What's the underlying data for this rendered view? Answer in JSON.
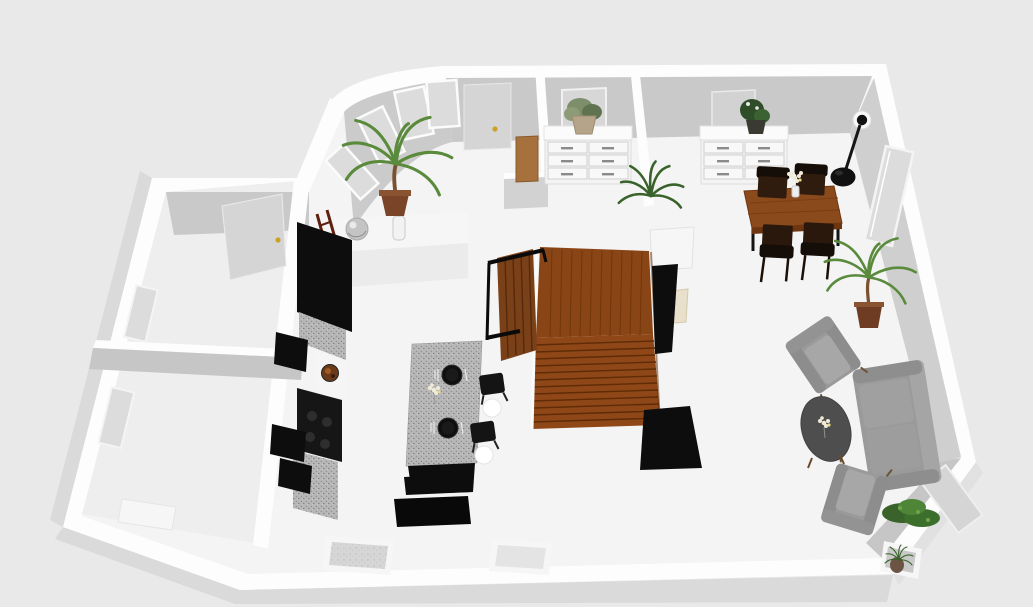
{
  "canvas": {
    "background": "#e9e9e9",
    "width": 1033,
    "height": 607
  },
  "scene": {
    "type": "3d-floor-plan-render",
    "camera": "elevated-perspective",
    "text_visible": false
  },
  "colors": {
    "wall_top": "#fdfdfd",
    "wall_face": "#c9c9c9",
    "wall_face_light": "#d2d2d2",
    "wall_outer_face": "#dadada",
    "floor": "#f4f4f4",
    "floor_annex": "#eeeeee",
    "window_glass": "#dcdcdc",
    "door_panel": "#d5d5d5",
    "handle_gold": "#c9a227",
    "stair_wood": "#8a4516",
    "stair_wood_dark": "#5e2c06",
    "railing_wood": "#7a4018",
    "table_wood": "#8b4a1c",
    "cabinet_black": "#0d0d0d",
    "granite_base": "#b7b7b7",
    "furniture_white": "#f6f6f6",
    "sofa_gray": "#9a9a9a",
    "coffee_table_gray": "#4e4e4e",
    "plant_green": "#5a8a3c",
    "plant_green_dark": "#39632a",
    "pot_brown": "#7a4428",
    "lamp_black": "#111111",
    "ladder_red": "#5e1f10",
    "pendant_white": "#ffffff"
  },
  "inventory": {
    "rooms": [
      {
        "id": "bedroom-upper-left",
        "objects": [
          "open-door-leaf",
          "wall-window"
        ]
      },
      {
        "id": "bedroom-lower-left",
        "objects": [
          "wall-window",
          "white-low-cabinet"
        ]
      },
      {
        "id": "hallway-bay",
        "objects": [
          "entry-door",
          "bay-windows-4",
          "tall-palm-plant",
          "console-table",
          "decor-sphere",
          "small-vase",
          "wood-cabinet",
          "half-wall"
        ]
      },
      {
        "id": "dressing-room",
        "objects": [
          "wall-mirror",
          "white-dresser-6-drawers",
          "potted-plant"
        ]
      },
      {
        "id": "kitchen",
        "objects": [
          "tall-black-cabinet",
          "ladder-rack",
          "white-appliance",
          "cooktop",
          "granite-counters",
          "wall-cubes-3",
          "island-granite",
          "place-setting-2",
          "bar-stool-2",
          "pendant-light-2",
          "black-bench-2",
          "bottom-window"
        ]
      },
      {
        "id": "stairwell",
        "objects": [
          "wood-staircase",
          "slat-railing",
          "black-panel",
          "white-cabinet",
          "storage-box"
        ]
      },
      {
        "id": "dining-room",
        "objects": [
          "white-sideboard",
          "potted-plant",
          "wall-mirror",
          "dining-table",
          "dining-chair-4",
          "flower-vase",
          "arc-floor-lamp",
          "palm-plant",
          "wall-window",
          "fern-plant"
        ]
      },
      {
        "id": "living-room",
        "objects": [
          "sofa-2-seat",
          "armchair-2",
          "oval-coffee-table",
          "flower-bouquet",
          "corner-bush",
          "chamfer-door",
          "niche-plant",
          "bottom-window"
        ]
      }
    ],
    "counts": {
      "dining_chairs": 4,
      "bar_stools": 2,
      "armchairs": 2,
      "pendant_lights": 2,
      "plants": 8,
      "windows": 9,
      "doors": 4
    }
  }
}
